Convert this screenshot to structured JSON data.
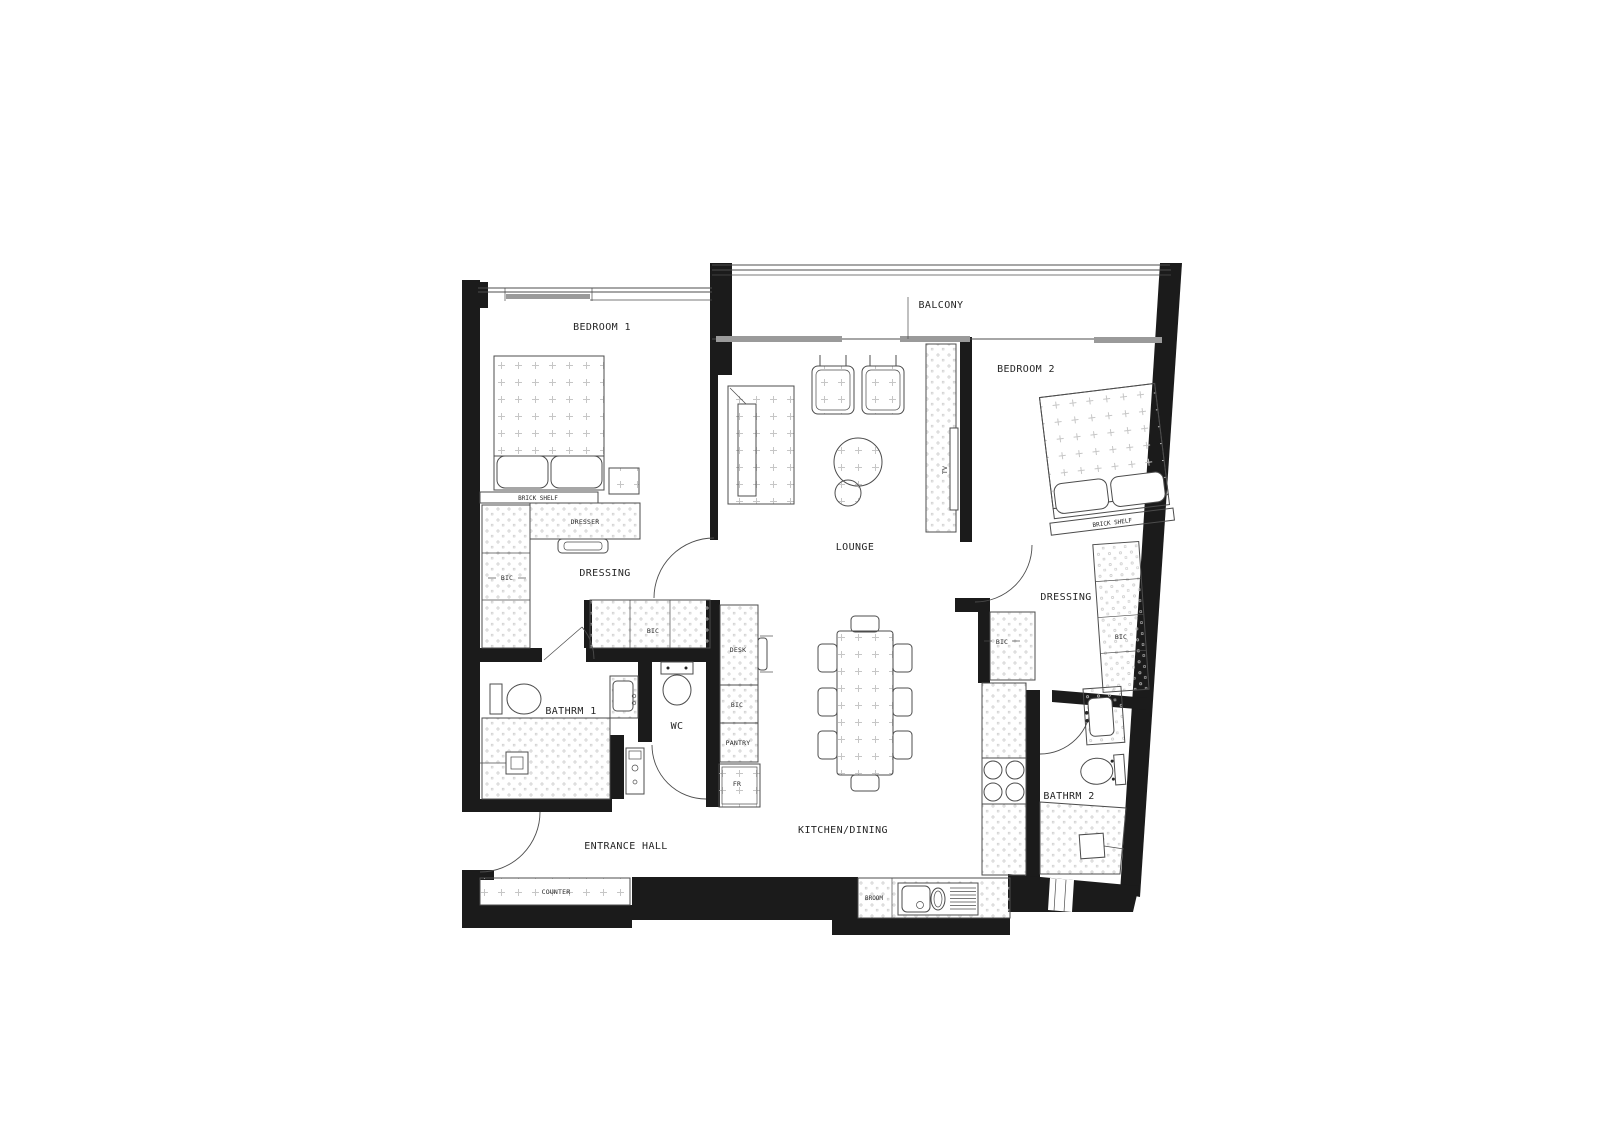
{
  "labels": {
    "bedroom1": "BEDROOM 1",
    "balcony": "BALCONY",
    "bedroom2": "BEDROOM 2",
    "brick_shelf1": "BRICK SHELF",
    "brick_shelf2": "BRICK SHELF",
    "dresser": "DRESSER",
    "dressing1": "DRESSING",
    "dressing2": "DRESSING",
    "bic1": "BIC",
    "bic2": "BIC",
    "bic3": "BIC",
    "bic4": "BIC",
    "bic5": "BIC",
    "bathrm1": "BATHRM 1",
    "bathrm2": "BATHRM 2",
    "wc": "WC",
    "desk": "DESK",
    "pantry": "PANTRY",
    "fridge": "FR",
    "tv": "TV",
    "lounge": "LOUNGE",
    "kitchen_dining": "KITCHEN/DINING",
    "entrance_hall": "ENTRANCE HALL",
    "counter": "COUNTER",
    "broom": "BROOM"
  },
  "colors": {
    "wall": "#1b1b1b",
    "line": "#4c4c4c",
    "hatch": "#c6c6c6",
    "sill": "#9a9a9a",
    "background": "#ffffff",
    "text": "#262626"
  }
}
